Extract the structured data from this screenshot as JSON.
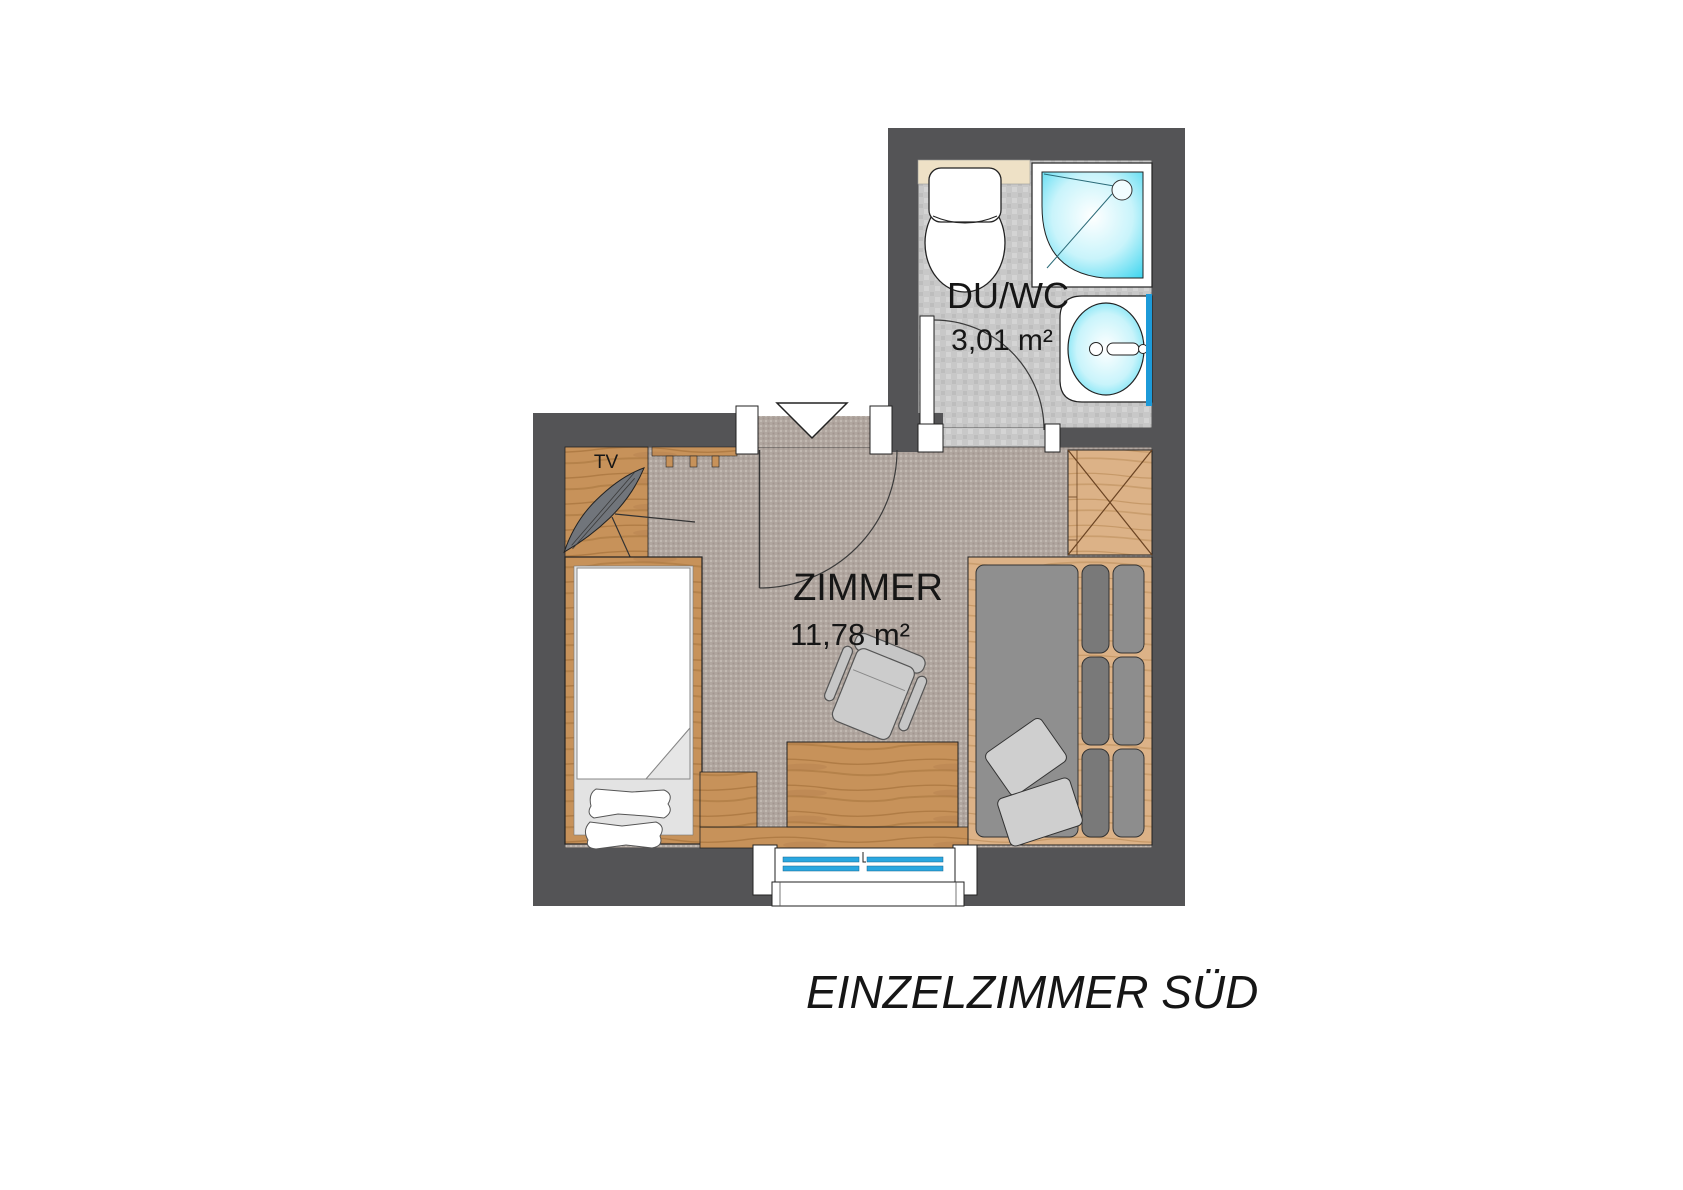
{
  "plan": {
    "title": "EINZELZIMMER SÜD",
    "rooms": [
      {
        "id": "bathroom",
        "name": "DU/WC",
        "area": "3,01 m²"
      },
      {
        "id": "bedroom",
        "name": "ZIMMER",
        "area": "11,78 m²"
      }
    ],
    "labels": {
      "tv": "TV"
    },
    "colors": {
      "wall": "#545456",
      "carpet_base": "#b1a7a0",
      "tile_base": "#c8c8c8",
      "wood": "#c7925a",
      "wood_light": "#dcb287",
      "shower_cyan": "#2fd2ee",
      "window_blue": "#2aa7e0",
      "mirror_blue": "#1d9ad8",
      "fixture_white": "#ffffff",
      "sofa_gray": "#8f8f8f",
      "text": "#161616"
    }
  }
}
